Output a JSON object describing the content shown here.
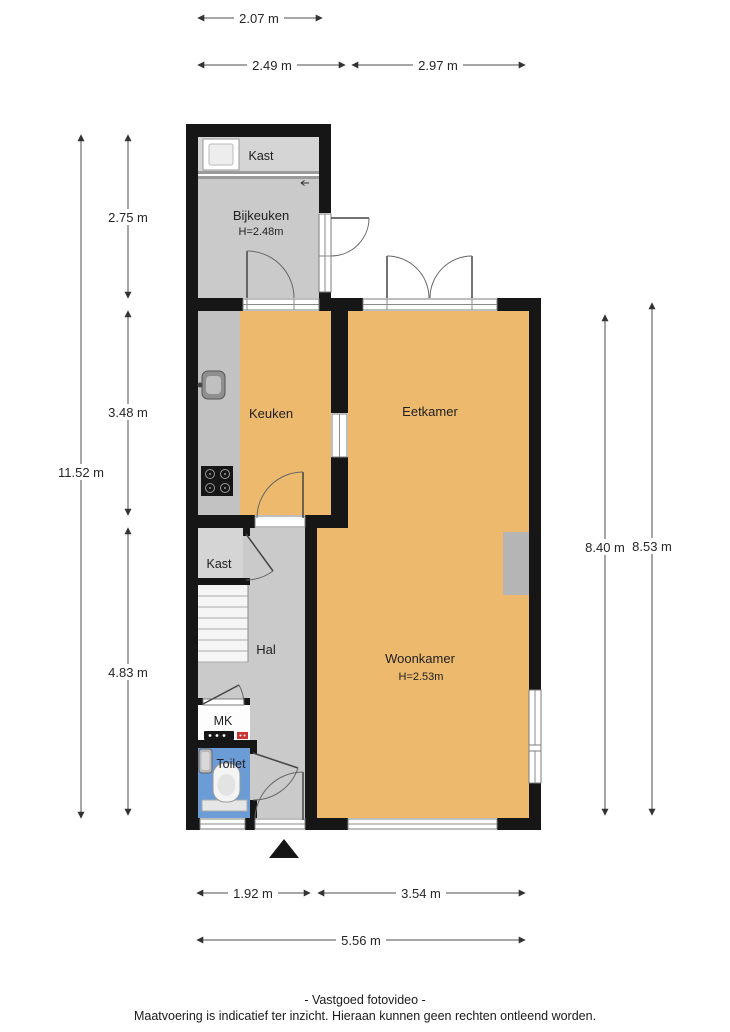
{
  "plan": {
    "rooms": {
      "kast_top": {
        "label": "Kast"
      },
      "bijkeuken": {
        "label": "Bijkeuken",
        "height": "H=2.48m"
      },
      "keuken": {
        "label": "Keuken"
      },
      "eetkamer": {
        "label": "Eetkamer"
      },
      "woonkamer": {
        "label": "Woonkamer",
        "height": "H=2.53m"
      },
      "kast_hal": {
        "label": "Kast"
      },
      "hal": {
        "label": "Hal"
      },
      "mk": {
        "label": "MK"
      },
      "toilet": {
        "label": "Toilet"
      }
    },
    "dimensions": {
      "top": [
        "2.07 m",
        "2.49 m",
        "2.97 m"
      ],
      "left": [
        "2.75 m",
        "3.48 m",
        "4.83 m",
        "11.52 m"
      ],
      "right": [
        "8.40 m",
        "8.53 m"
      ],
      "bottom": [
        "1.92 m",
        "3.54 m",
        "5.56 m"
      ]
    },
    "colors": {
      "wall": "#161616",
      "room_orange": "#ECB96D",
      "room_gray": "#CACACA",
      "room_gray_light": "#D5D5D5",
      "counter_gray": "#C2C2C2",
      "toilet_blue": "#6C9CD6",
      "chimney_gray": "#B5B5B5",
      "meter_red": "#CC3333"
    },
    "footer": {
      "line1": "- Vastgoed fotovideo -",
      "line2": "Maatvoering is indicatief ter inzicht. Hieraan kunnen geen rechten ontleend worden."
    }
  }
}
